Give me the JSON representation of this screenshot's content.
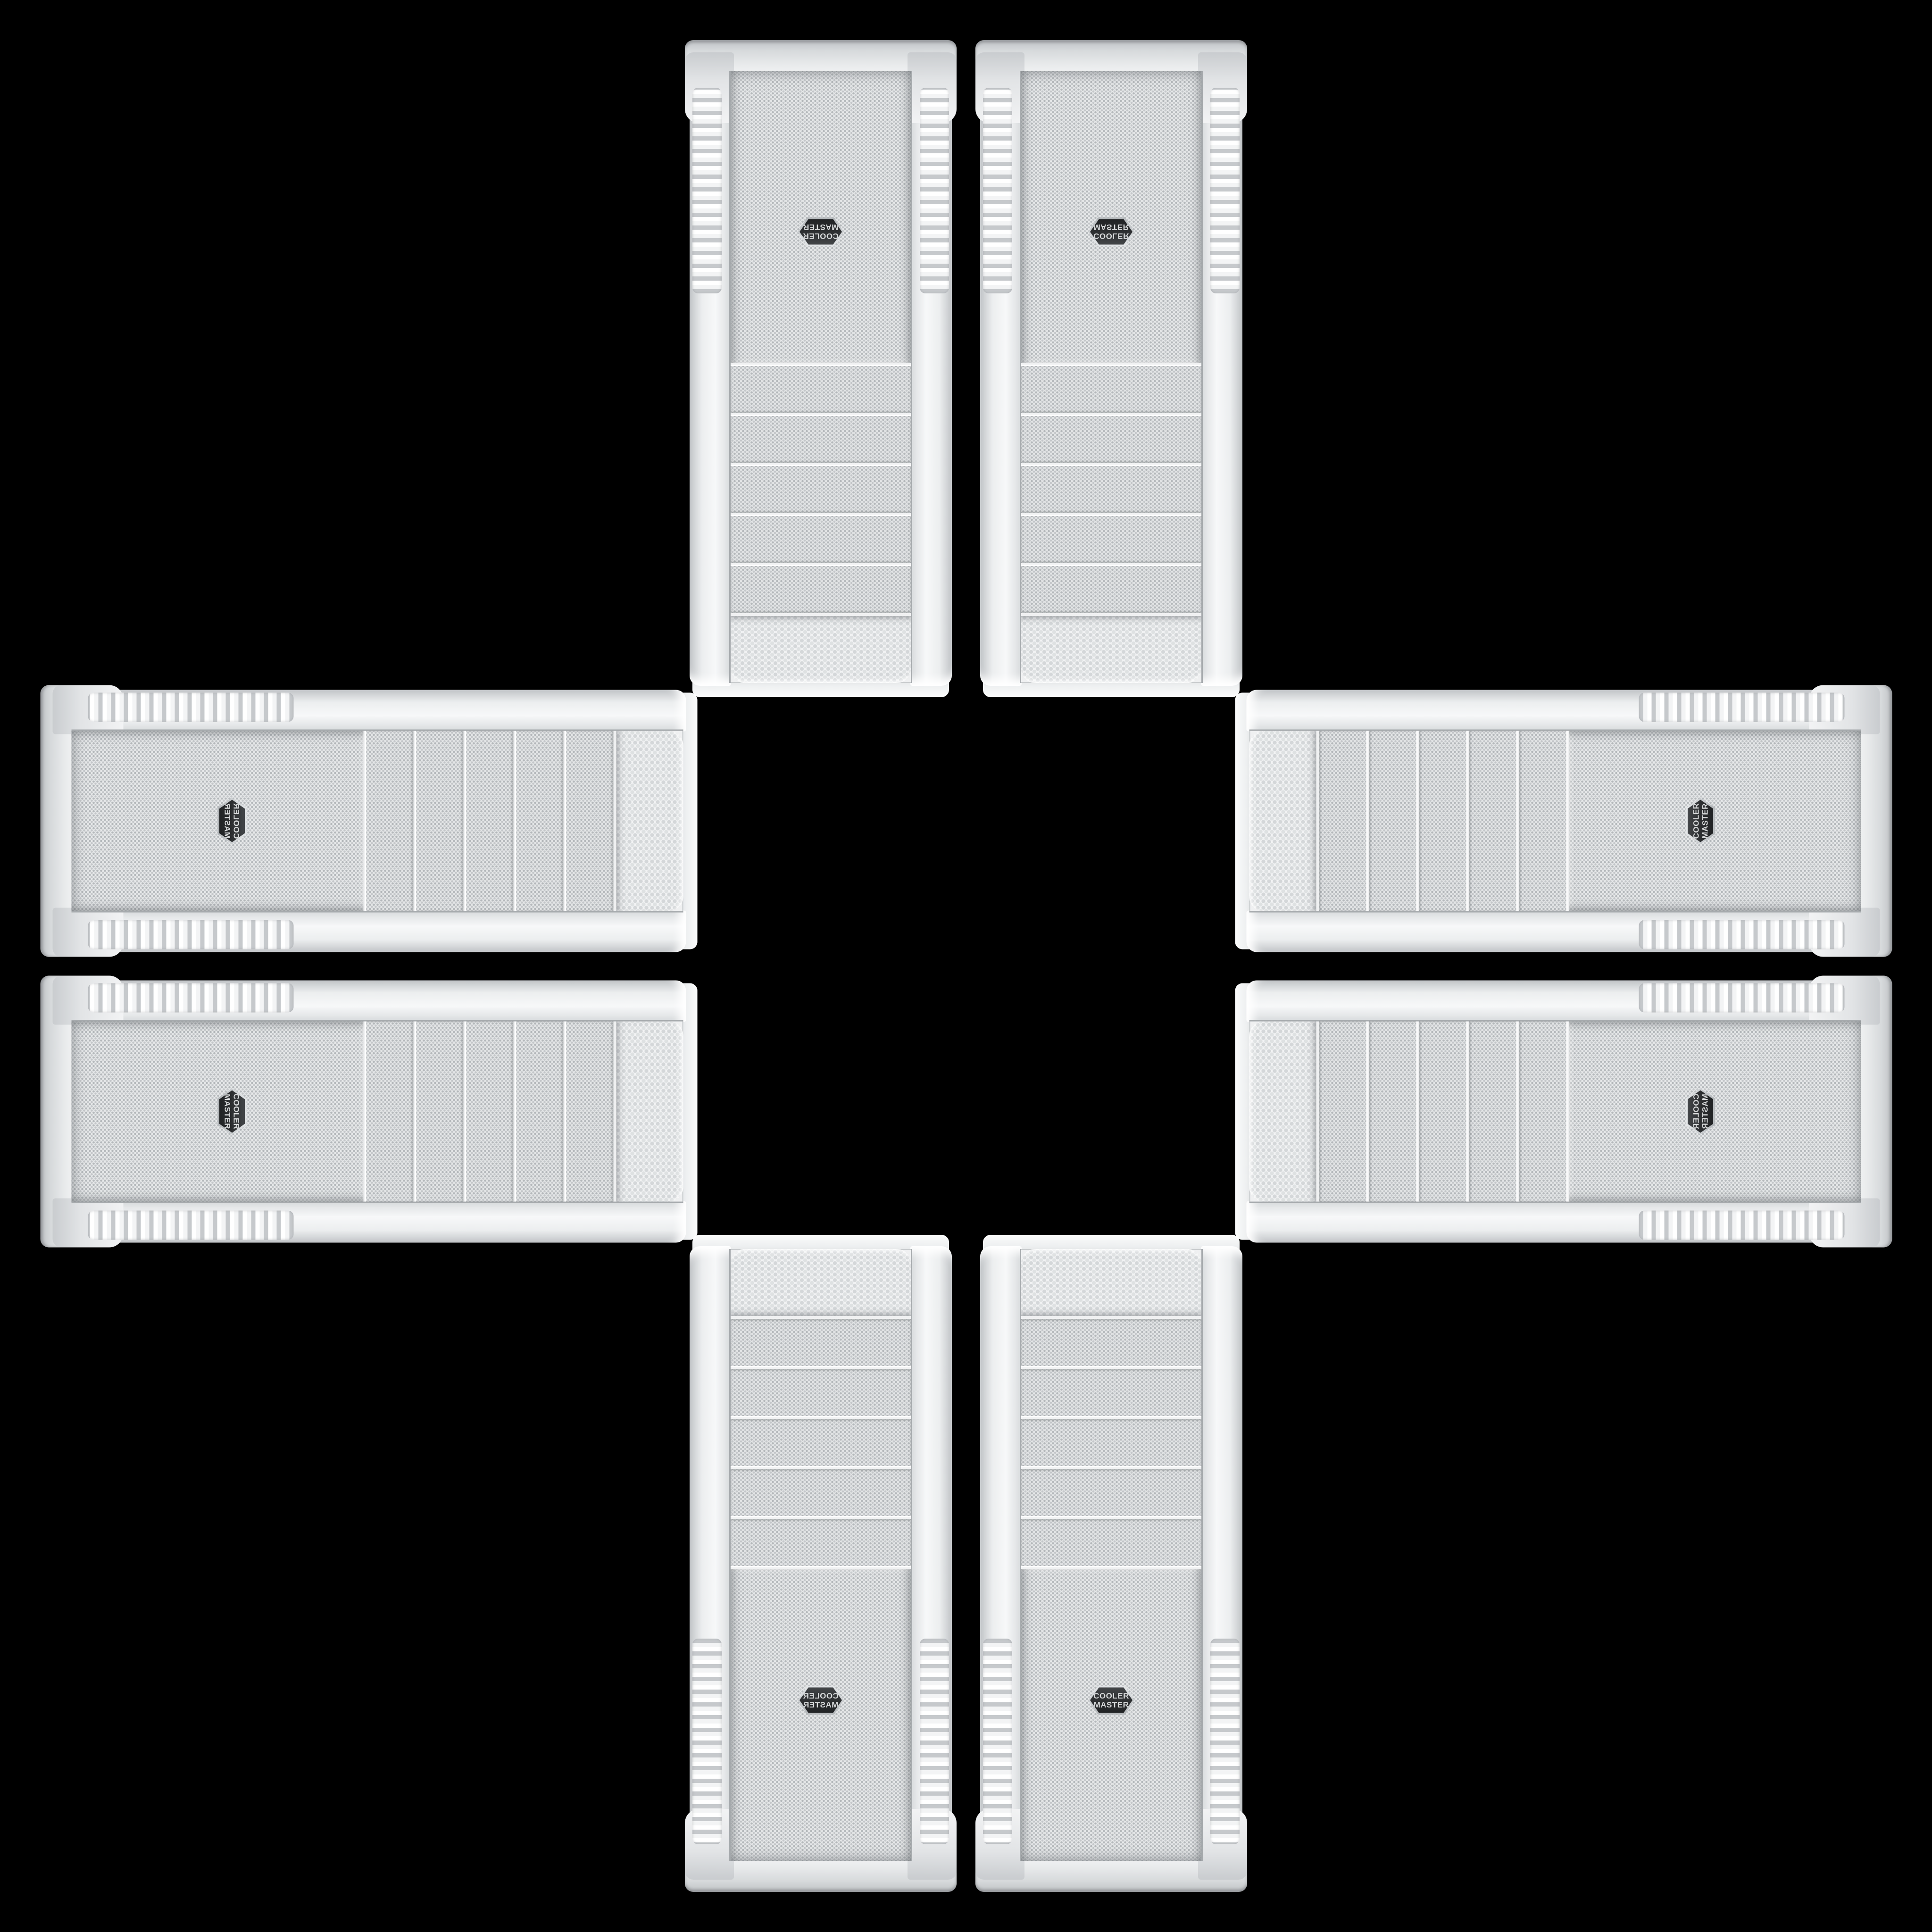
{
  "brand_badge": {
    "line1": "COOLER",
    "line2": "MASTER"
  },
  "colors": {
    "background": "#000000",
    "chassis_white": "#f0f2f3",
    "chassis_shadow": "#c4c7ca",
    "mesh_base": "#e7e9ea",
    "mesh_dot": "#b3b7ba",
    "badge_background": "#2b2d2f",
    "badge_rim": "#c9cdd0",
    "badge_text": "#d8dadb"
  },
  "cases": [
    {
      "id": "top-left",
      "label": "Cooler Master white tower case, upside down, mirrored"
    },
    {
      "id": "top-right",
      "label": "Cooler Master white tower case, upside down"
    },
    {
      "id": "left-top",
      "label": "Cooler Master white tower case, lying horizontal, mirrored"
    },
    {
      "id": "left-bottom",
      "label": "Cooler Master white tower case, lying horizontal"
    },
    {
      "id": "right-top",
      "label": "Cooler Master white tower case, lying horizontal"
    },
    {
      "id": "right-bottom",
      "label": "Cooler Master white tower case, lying horizontal, mirrored"
    },
    {
      "id": "bottom-left",
      "label": "Cooler Master white tower case, upright, mirrored"
    },
    {
      "id": "bottom-right",
      "label": "Cooler Master white tower case, upright"
    }
  ]
}
